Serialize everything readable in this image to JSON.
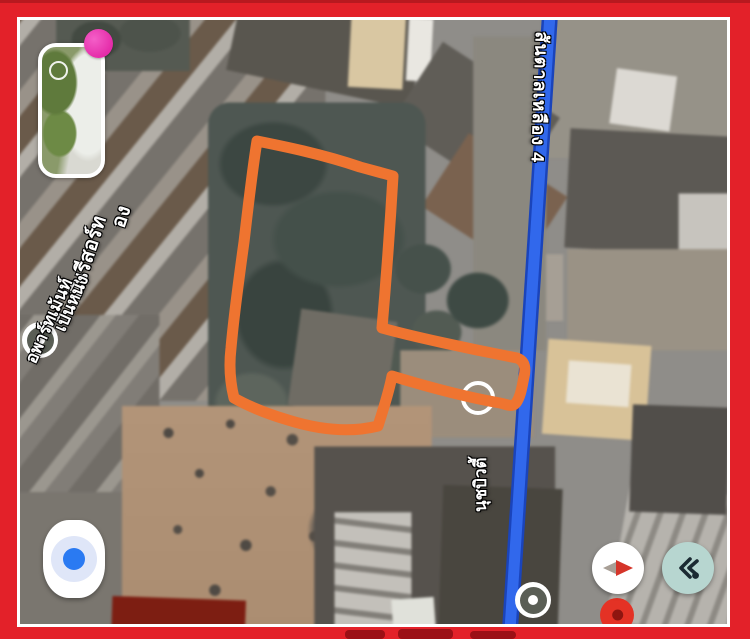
{
  "app": {
    "type": "satellite-map-screenshot",
    "description": "Google-Maps-style satellite view with hand-drawn plot outline, framed by red border"
  },
  "labels": {
    "road": "สันตาลเหลือง 4",
    "resort": "ลินรีสอร์ท",
    "resort_fragment": "อง",
    "apartment_line1": "เป็นหนึ่ง",
    "apartment_line2": "อพาร์ทเม้นท์",
    "beauty_shop": "นุชบิวตี้"
  },
  "icons": {
    "my_location": "blue-dot-in-pale-ring",
    "compass": "red-and-gray-needle",
    "explore": "dark-double-chevron-with-dot",
    "photo_badge": "pink-circle",
    "camera": "white-circle-outline",
    "poi_marker": "white-ring-gray-disc",
    "red_pin": "red-teardrop"
  },
  "colors": {
    "frame_red": "#e32129",
    "frame_inner_line": "#ffffff",
    "road_blue": "#3168ec",
    "road_casing": "#1a44bb",
    "outline_orange": "#ef7430",
    "pin_red": "#e43225",
    "badge_pink": "#e52ca9",
    "location_blue": "#2a7af2",
    "explore_button_teal": "#b7d6d0",
    "explore_icon_dark": "#1b2a32",
    "compass_red": "#d5352a",
    "compass_gray": "#a89f96",
    "label_text": "#ffffff"
  }
}
